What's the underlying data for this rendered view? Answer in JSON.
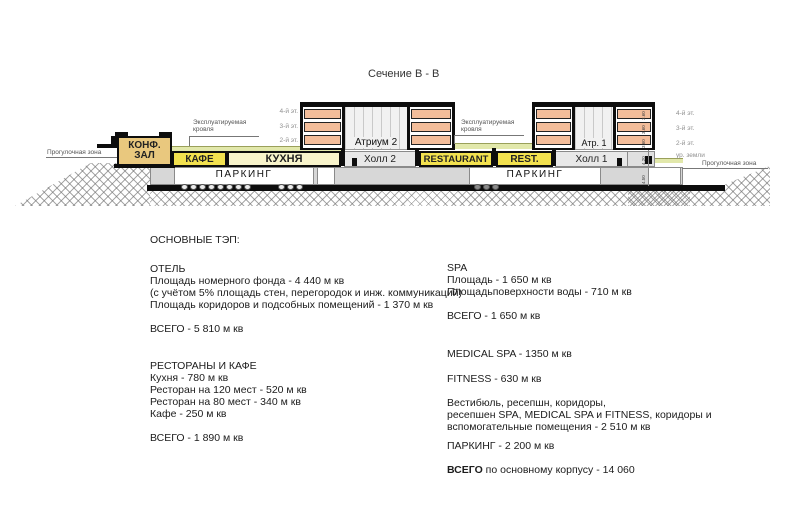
{
  "title": "Сечение В - В",
  "section": {
    "walkway_left": "Прогулочная зона",
    "walkway_right": "Прогулочная зона",
    "ground_level": "ур. земли",
    "roof_label": "Эксплуатируемая кровля",
    "conf_hall_line1": "КОНФ.",
    "conf_hall_line2": "ЗАЛ",
    "rooms": {
      "cafe": "КАФЕ",
      "kitchen": "КУХНЯ",
      "hall2": "Холл 2",
      "restaurant": "RESTAURANT",
      "rest": "REST.",
      "hall1": "Холл 1"
    },
    "atrium2": "Атриум 2",
    "atrium1": "Атр. 1",
    "parking": "ПАРКИНГ",
    "floors": [
      "4-й эт.",
      "3-й эт.",
      "2-й эт."
    ],
    "dims": [
      "3.60",
      "3.60",
      "3.60",
      "4.20",
      "4.50"
    ],
    "colors": {
      "floor_slab_salmon": "#f3bd9a",
      "room_yellow": "#f2e14f",
      "kitchen_pale_yellow": "#f8f4cb",
      "conf_hall_tan": "#e9c87e",
      "green_roof": "#e2e8ab",
      "hall_gray": "#e8e8e8",
      "parking_gray": "#d7d7d7"
    }
  },
  "tep": {
    "header": "ОСНОВНЫЕ ТЭП:",
    "left": [
      {
        "title": "ОТЕЛЬ",
        "lines": [
          "Площадь номерного фонда - 4 440 м кв",
          "(с учётом 5% площадь стен, перегородок и инж. коммуникаций)",
          "Площадь коридоров и подсобных помещений - 1 370 м кв"
        ],
        "total": "ВСЕГО - 5 810 м кв"
      },
      {
        "title": "РЕСТОРАНЫ И КАФЕ",
        "lines": [
          "Кухня - 780 м кв",
          "Ресторан на 120 мест - 520 м кв",
          "Ресторан на 80 мест - 340 м кв",
          "Кафе - 250 м кв"
        ],
        "total": "ВСЕГО - 1 890 м кв"
      }
    ],
    "right": {
      "spa_title": "SPA",
      "spa_lines": [
        "Площадь - 1 650 м кв",
        "Площадьповерхности воды - 710 м кв"
      ],
      "spa_total": "ВСЕГО - 1 650 м кв",
      "medical": "MEDICAL SPA - 1350 м кв",
      "fitness": "FITNESS - 630 м кв",
      "misc_lines": [
        "Вестибюль, ресепшн, коридоры,",
        "ресепшен SPA, MEDICAL SPA и FITNESS, коридоры и",
        "вспомогательные помещения - 2 510 м кв"
      ],
      "parking": "ПАРКИНГ - 2 200 м кв",
      "total_bold": "ВСЕГО",
      "total_rest": " по основному корпусу - 14 060"
    }
  }
}
